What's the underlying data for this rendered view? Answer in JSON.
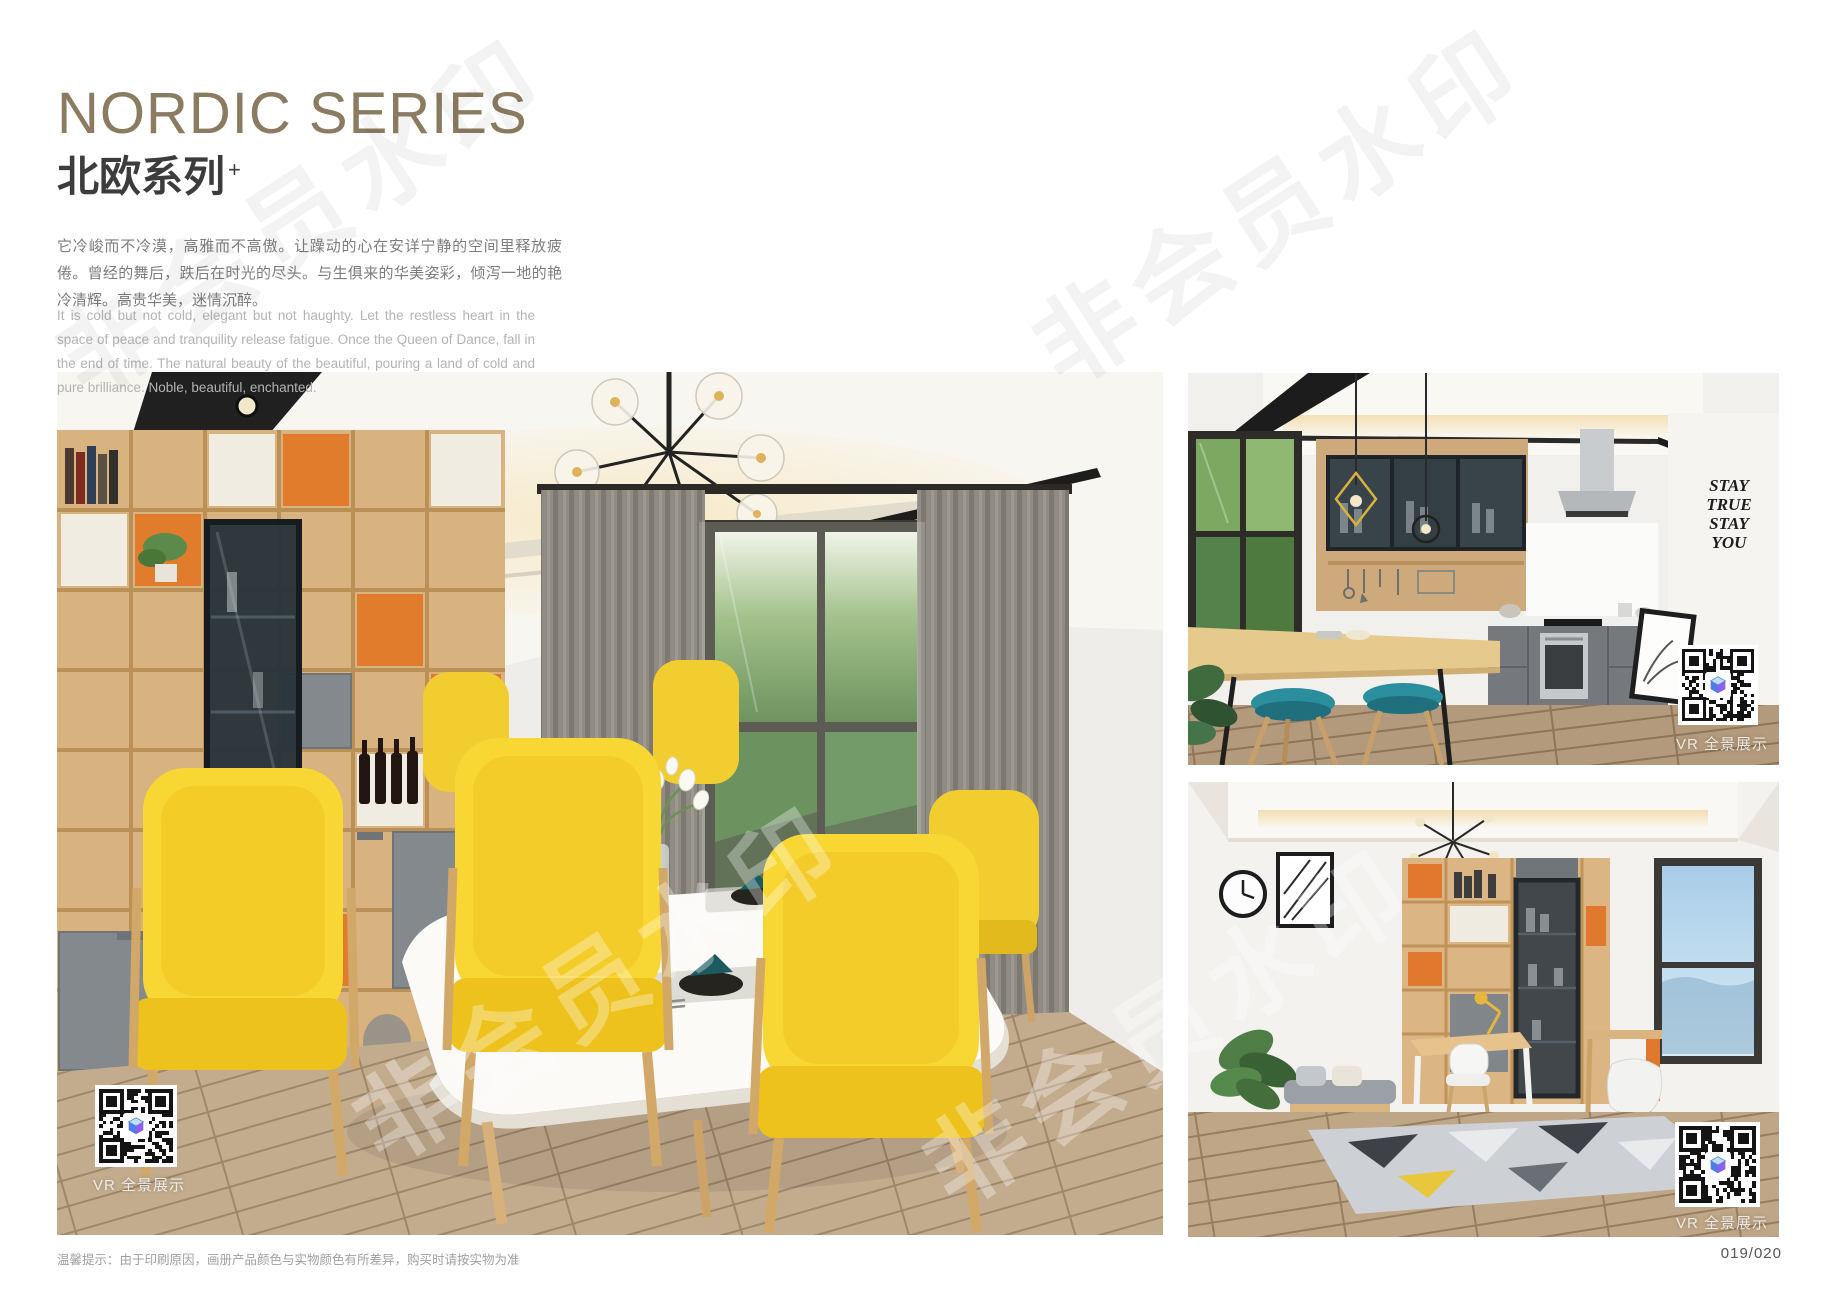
{
  "header": {
    "title": "NORDIC SERIES",
    "subtitle_zh": "北欧系列",
    "subtitle_mark": "+",
    "paragraph_zh": "它冷峻而不冷漠，高雅而不高傲。让躁动的心在安详宁静的空间里释放疲倦。曾经的舞后，跌后在时光的尽头。与生俱来的华美姿彩，倾泻一地的艳冷清辉。高贵华美，迷情沉醉。",
    "paragraph_en": "It is cold but not cold, elegant but not haughty. Let the restless heart in the space of peace and tranquility release fatigue. Once the Queen of Dance, fall in the end of time. The natural beauty of the beautiful, pouring a land of cold and pure brilliance. Noble, beautiful, enchanted."
  },
  "watermark": {
    "text": "非会员水印"
  },
  "photos": {
    "dining": {
      "caption": "VR 全景展示"
    },
    "kitchen": {
      "caption": "VR 全景展示",
      "wall_decal": [
        "STAY",
        "TRUE",
        "STAY",
        "YOU"
      ]
    },
    "study": {
      "caption": "VR 全景展示"
    }
  },
  "footer": {
    "disclaimer": "温馨提示：由于印刷原因，画册产品颜色与实物颜色有所差异，购买时请按实物为准",
    "page_number": "019/020"
  },
  "colors": {
    "title_accent": "#8b7b61",
    "chair_yellow": "#f8d734",
    "cabinet_orange": "#e07c2c",
    "cabinet_gray": "#84898e",
    "stool_teal": "#2b8e9d",
    "wood": "#d8b27f"
  }
}
